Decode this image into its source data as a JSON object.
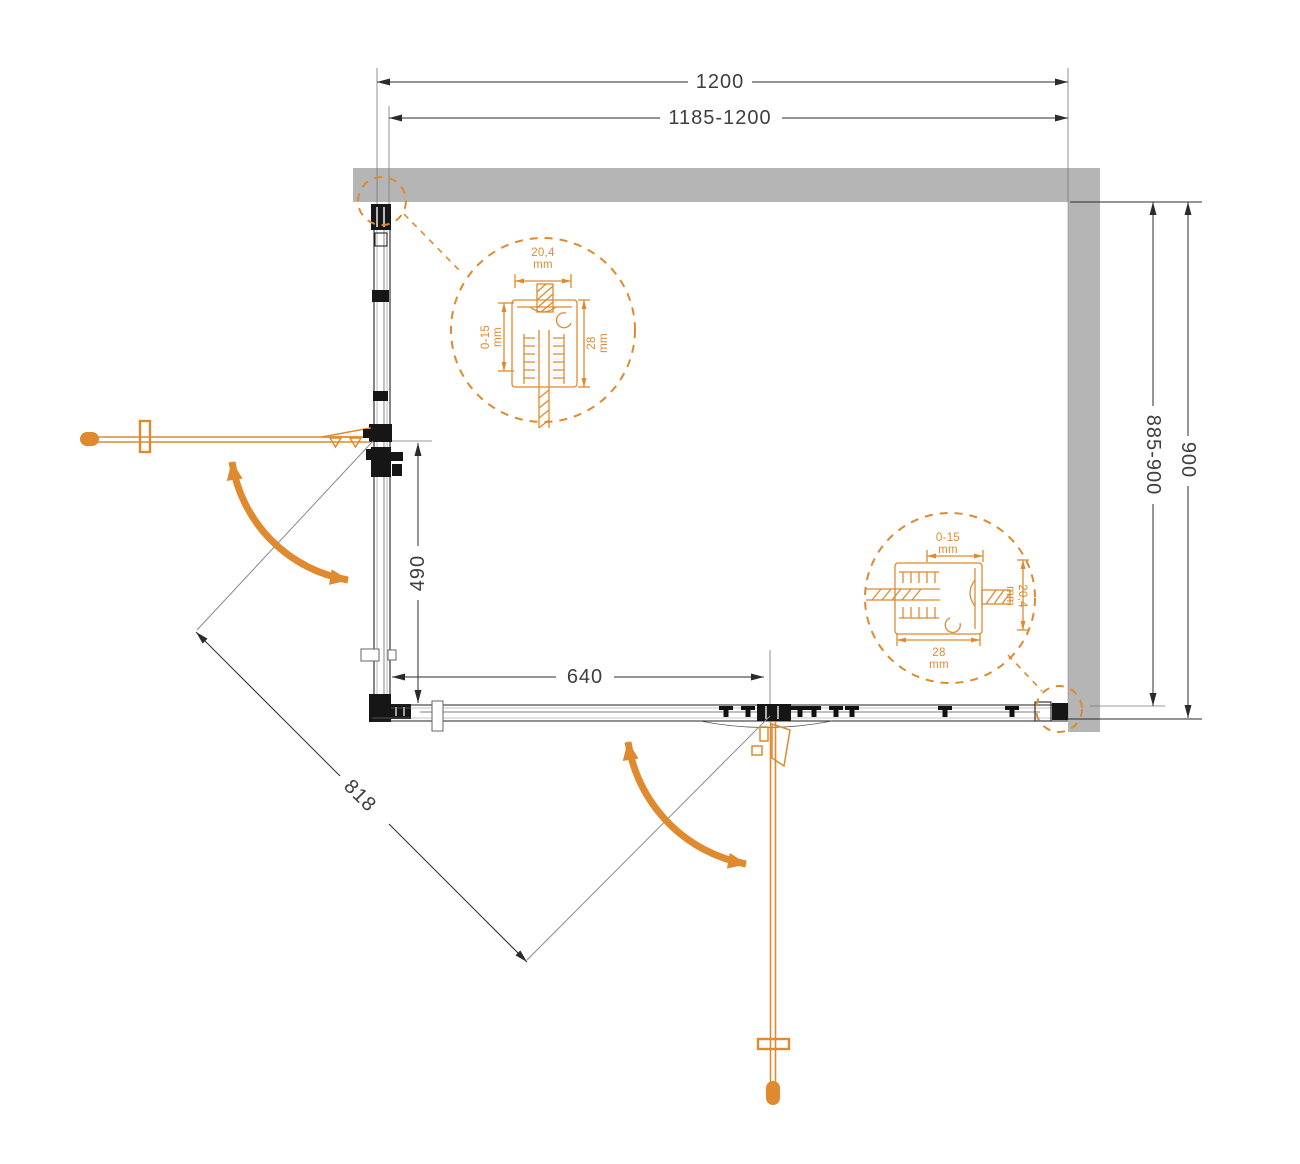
{
  "dimensions": {
    "top_outer": "1200",
    "top_range": "1185-1200",
    "right_outer": "900",
    "right_range": "885-900",
    "side_panel": "490",
    "door_front": "640",
    "diagonal_opening": "818"
  },
  "detail_wall_profile_top": {
    "width": "20,4",
    "width_unit": "mm",
    "adjustment": "0-15",
    "adjustment_unit": "mm",
    "depth": "28",
    "depth_unit": "mm"
  },
  "detail_wall_profile_right": {
    "adjustment": "0-15",
    "adjustment_unit": "mm",
    "width": "20,4",
    "width_unit": "mm",
    "depth": "28",
    "depth_unit": "mm"
  },
  "colors": {
    "accent_orange": "#DF8A2E",
    "wall_gray": "#B5B5B5",
    "frame_black": "#1A1A1A",
    "dim_text": "#3E3E3E"
  }
}
